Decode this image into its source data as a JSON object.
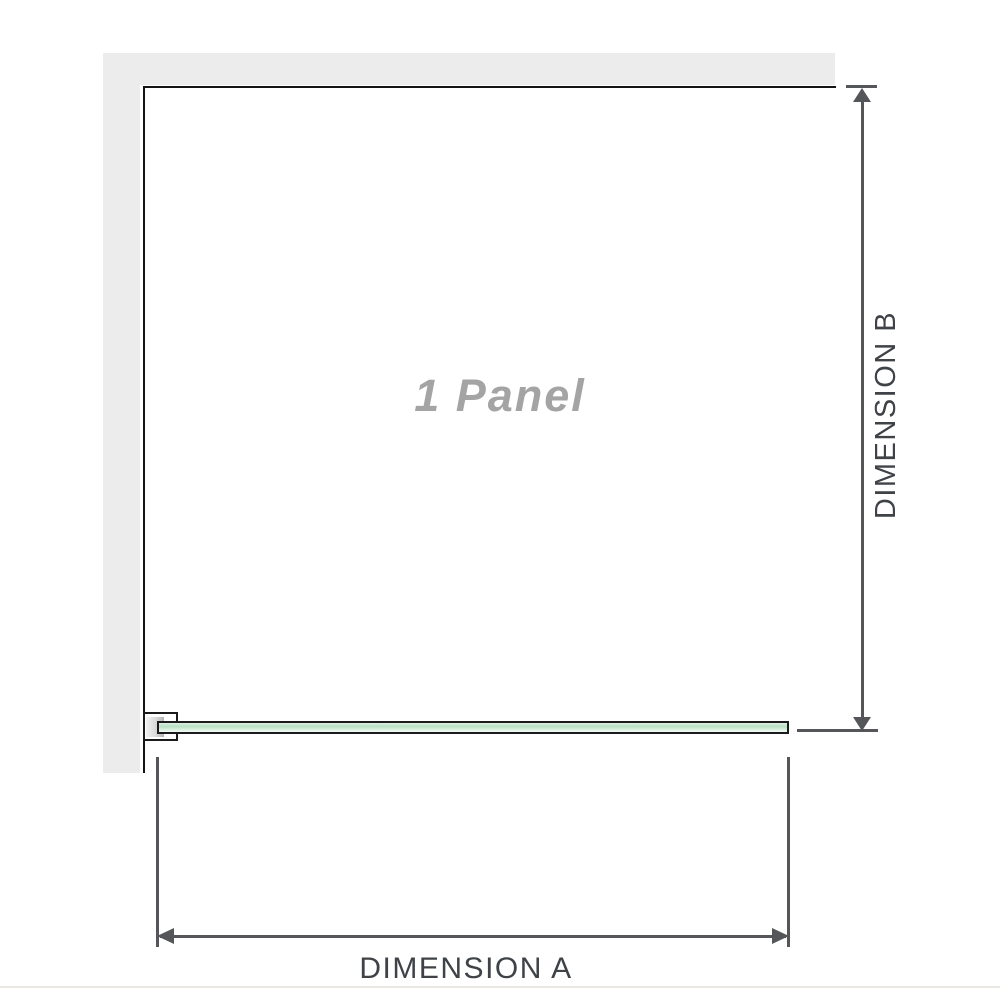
{
  "diagram": {
    "type": "product-dimension-drawing",
    "panel_label": "1 Panel",
    "dimension_a_label": "DIMENSION A",
    "dimension_b_label": "DIMENSION B"
  },
  "colors": {
    "wall": "#ececec",
    "panel_border": "#141414",
    "line": "#54565a",
    "label_text": "#3f4347",
    "panel_label_text": "#a4a4a4",
    "glass_border": "#1b1b1b",
    "glass_top": "#ddefe2",
    "glass_mid": "#b7e0c3",
    "glass_low": "#d9efdf",
    "glass_bottom": "#f2faf4",
    "baseline": "#eae7e2"
  }
}
